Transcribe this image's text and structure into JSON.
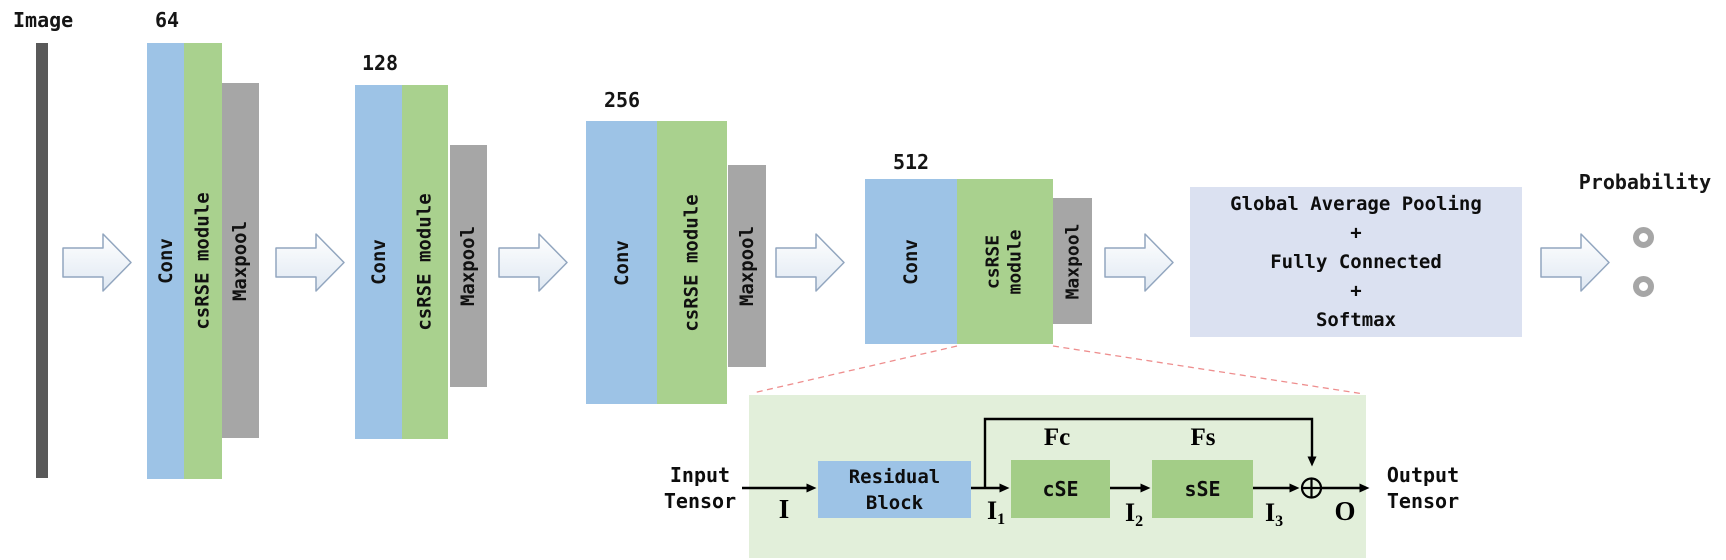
{
  "labels": {
    "image": "Image",
    "probability": "Probability"
  },
  "groups": [
    {
      "depth": "64",
      "conv": "Conv",
      "csrse": "csRSE module",
      "maxpool": "Maxpool"
    },
    {
      "depth": "128",
      "conv": "Conv",
      "csrse": "csRSE module",
      "maxpool": "Maxpool"
    },
    {
      "depth": "256",
      "conv": "Conv",
      "csrse": "csRSE module",
      "maxpool": "Maxpool"
    },
    {
      "depth": "512",
      "conv": "Conv",
      "csrse_line1": "csRSE",
      "csrse_line2": "module",
      "maxpool": "Maxpool"
    }
  ],
  "head": {
    "lines": [
      "Global Average Pooling",
      "+",
      "Fully Connected",
      "+",
      "Softmax"
    ]
  },
  "module_detail": {
    "input_line1": "Input",
    "input_line2": "Tensor",
    "output_line1": "Output",
    "output_line2": "Tensor",
    "residual_line1": "Residual",
    "residual_line2": "Block",
    "cse": "cSE",
    "sse": "sSE",
    "fc": "Fc",
    "fs": "Fs",
    "i": "I",
    "i1_base": "I",
    "i1_sub": "1",
    "i2_base": "I",
    "i2_sub": "2",
    "i3_base": "I",
    "i3_sub": "3",
    "o": "O",
    "sum_symbol": "plus-circle"
  },
  "colors": {
    "conv_blue": "#9dc3e6",
    "csrse_green": "#a9d18e",
    "se_box_green": "#a3cd87",
    "maxpool_gray": "#a6a6a6",
    "image_bar_gray": "#595959",
    "head_box_lavender": "#dbe1f1",
    "module_panel_green": "#e2efda",
    "dashed_connector_red": "#ee8e8e",
    "probability_node_gray": "#a6a6a6",
    "flow_arrow_outline": "#92a6bf"
  }
}
